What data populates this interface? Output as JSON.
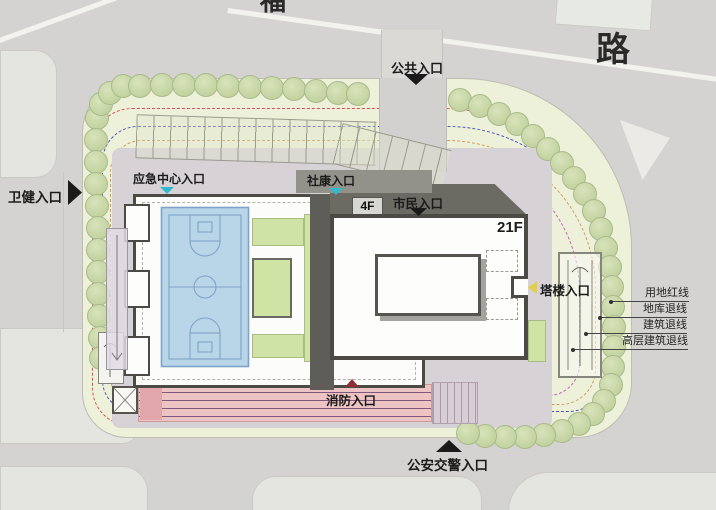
{
  "map": {
    "road": "路",
    "road_partial": "福"
  },
  "entrances": {
    "public": "公共入口",
    "health": "卫健入口",
    "emergency_center": "应急中心入口",
    "community_clinic": "社康入口",
    "citizen": "市民入口",
    "tower": "塔楼入口",
    "fire": "消防入口",
    "police_traffic": "公安交警入口"
  },
  "buildings": {
    "podium_floors": "4F",
    "tower_floors": "21F"
  },
  "legend": {
    "items": [
      {
        "label": "用地红线",
        "color": "#d94f4f"
      },
      {
        "label": "地库退线",
        "color": "#5055bd"
      },
      {
        "label": "建筑退线",
        "color": "#cf9a5e"
      },
      {
        "label": "高层建筑退线",
        "color": "#c95fc2"
      }
    ]
  },
  "colors": {
    "road": "#d5d3d1",
    "site_green": "#eef1d9",
    "paving": "#d7d2d6",
    "walkway": "#d3d0d0",
    "roof_dark": "#6b6a63",
    "roof_bar": "#92918a",
    "roof_sliver": "#5e5d57",
    "building_white": "#fdfdfb",
    "court_blue": "#b9d5e8",
    "landscape_green": "#cfe3a4",
    "fire_lane_pink": "#eec3c3",
    "fire_lane_dark": "#e2a7aa",
    "marker_cyan": "#35b7cc",
    "marker_yellow": "#e3cf45",
    "marker_dark_red": "#8e2f38",
    "marker_black": "#1a1a1a"
  }
}
